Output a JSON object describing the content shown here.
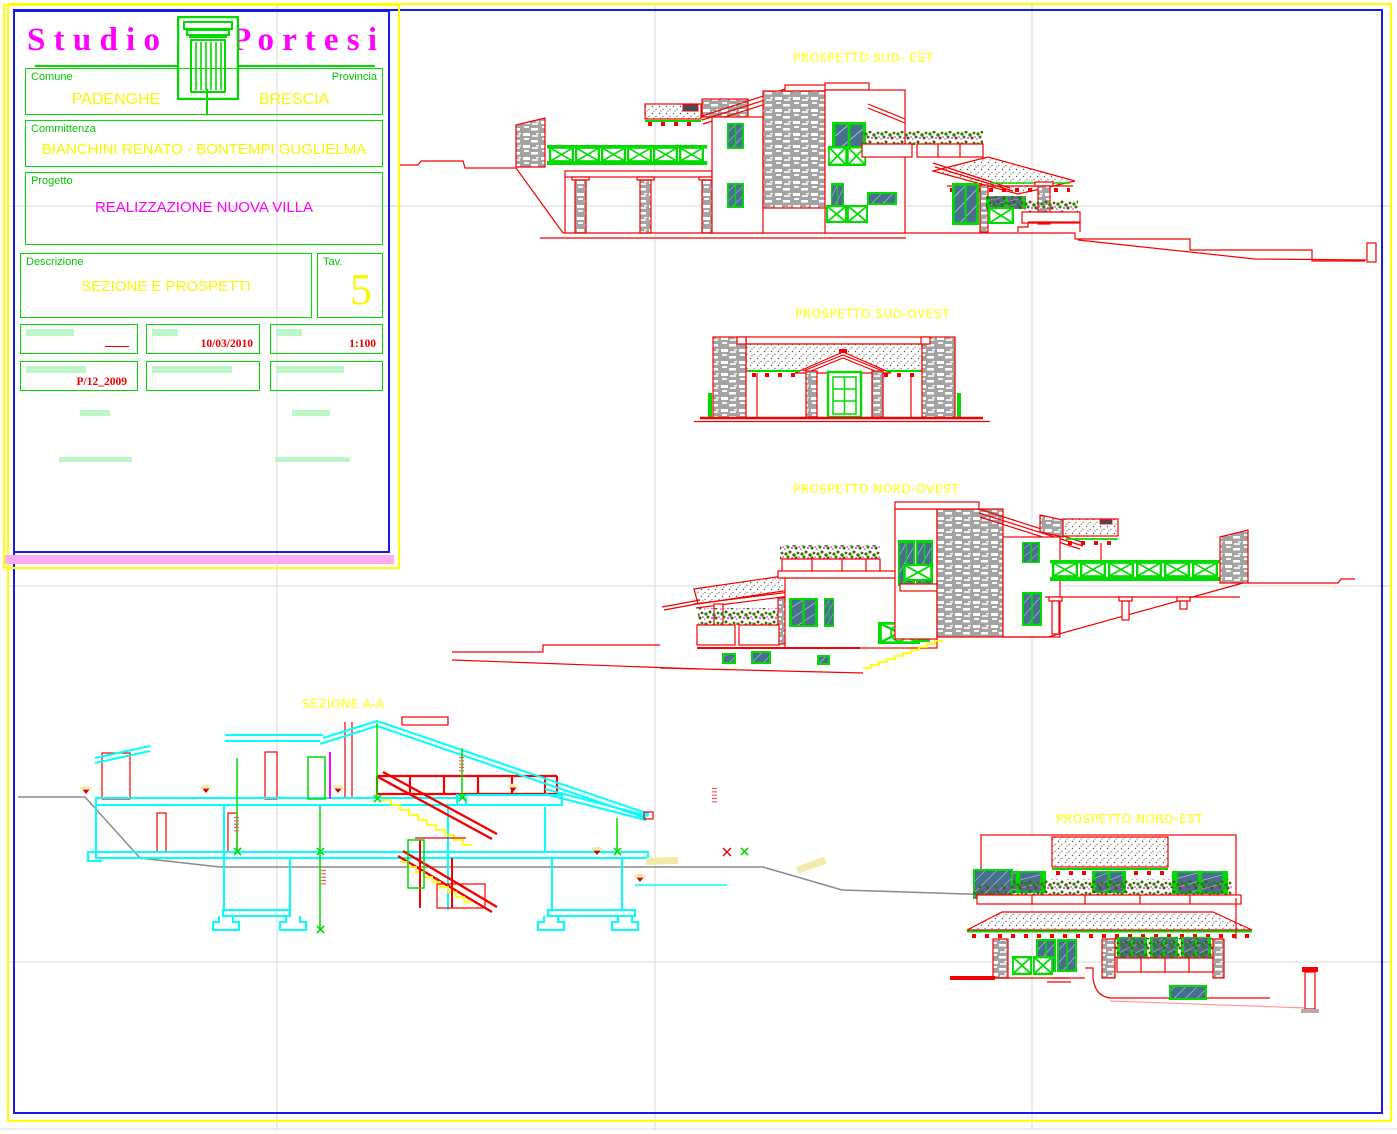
{
  "sheet": {
    "width_px": 1397,
    "height_px": 1134,
    "colors": {
      "outer_border": "#ffff00",
      "inner_border": "#1a1ae6",
      "cad_red": "#f40000",
      "cad_green": "#00dc00",
      "cad_yellow": "#ffff00",
      "cad_cyan": "#00ffff",
      "cad_magenta": "#ff00ff",
      "stone_gray": "#a3a3a3",
      "glass_blue": "#47708e"
    }
  },
  "title_block": {
    "studio_name_left": "S t u d i o",
    "studio_name_right": "P o r t e s i",
    "logo_icon": "classical-column-capital",
    "comune": {
      "label": "Comune",
      "value": "PADENGHE"
    },
    "provincia": {
      "label": "Provincia",
      "value": "BRESCIA"
    },
    "committenza": {
      "label": "Committenza",
      "value": "BIANCHINI RENATO - BONTEMPI GUGLIELMA"
    },
    "progetto": {
      "label": "Progetto",
      "value": "REALIZZAZIONE NUOVA VILLA"
    },
    "descrizione": {
      "label": "Descrizione",
      "value": "SEZIONE E PROSPETTI"
    },
    "tav": {
      "label": "Tav.",
      "value": "5"
    },
    "date": "10/03/2010",
    "scale": "1:100",
    "protocol": "P/12_2009"
  },
  "drawings": {
    "sud_est": {
      "label": "PROSPETTO SUD- EST"
    },
    "sud_ovest": {
      "label": "PROSPETTO SUD-OVEST"
    },
    "nord_ovest": {
      "label": "PROSPETTO NORD-OVEST"
    },
    "sezione": {
      "label": "SEZIONE A-A"
    },
    "nord_est": {
      "label": "PROSPETTO NORD-EST"
    }
  }
}
